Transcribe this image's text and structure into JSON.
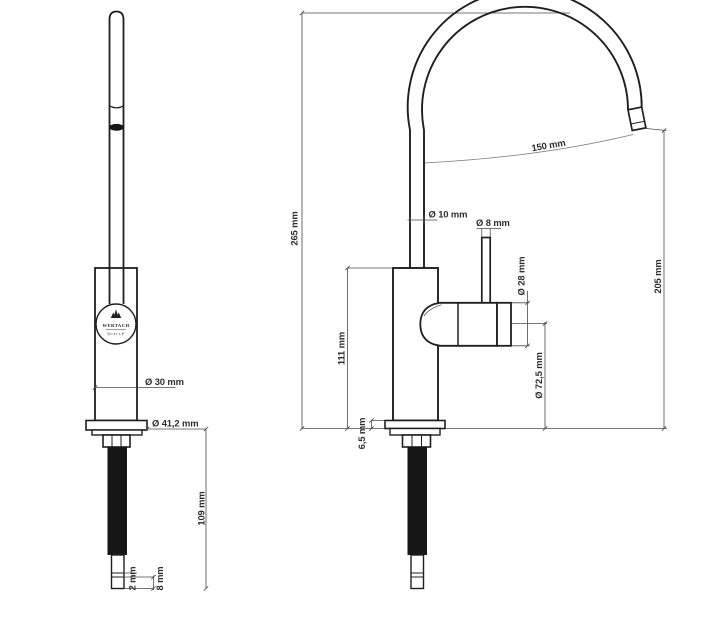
{
  "drawing": {
    "background": "#ffffff",
    "outline_color": "#1f1f1f",
    "dimension_line_color": "#4a4a4a",
    "label_text_color": "#2e2e2e"
  },
  "brand": {
    "name": "WERTACH",
    "subtitle": "QUELLE"
  },
  "front_view": {
    "dims": {
      "body_diameter": "Ø 30 mm",
      "flange_diameter": "Ø 41,2 mm",
      "thread_length": "109 mm",
      "tip_groove": "2 mm",
      "tip_end": "8 mm"
    }
  },
  "side_view": {
    "dims": {
      "total_height": "265 mm",
      "spout_reach": "150 mm",
      "spout_tube_diameter": "Ø 10 mm",
      "lever_rod_diameter": "Ø 8 mm",
      "handle_diameter": "Ø 28 mm",
      "outlet_height": "205 mm",
      "body_height": "111 mm",
      "handle_axis_height": "Ø 72,5 mm",
      "flange_thickness": "6,5 mm"
    }
  }
}
